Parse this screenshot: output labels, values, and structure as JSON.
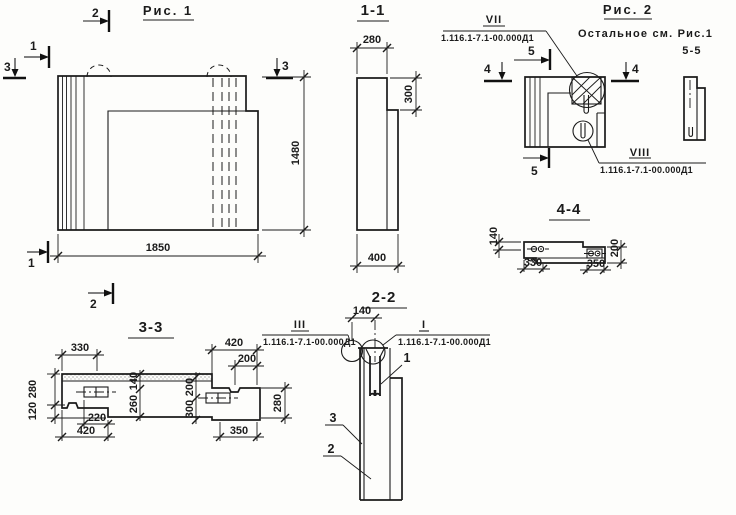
{
  "colors": {
    "ink": "#1b1b1b",
    "paper": "#fdfdfb"
  },
  "fig1": {
    "title": "Рис. 1",
    "dim_width": "1850",
    "dim_height": "1480",
    "marker_top": "2",
    "marker_upper_left": "1",
    "marker_left": "3",
    "marker_right": "3",
    "marker_bottom_left": "1",
    "marker_bottom": "2"
  },
  "sec11": {
    "title": "1-1",
    "dim_top": "280",
    "dim_step": "300",
    "dim_bottom": "400"
  },
  "fig2": {
    "title": "Рис. 2",
    "note1": "Остальное см. Рис.1",
    "note2": "5-5",
    "marker_top": "5",
    "marker_bottom": "5",
    "marker_left": "4",
    "marker_right": "4",
    "callout_vii": {
      "label": "VII",
      "doc": "1.116.1-7.1-00.000Д1"
    },
    "callout_viii": {
      "label": "VIII",
      "doc": "1.116.1-7.1-00.000Д1"
    }
  },
  "sec44": {
    "title": "4-4",
    "dim_left": "140",
    "dim_right": "200",
    "dim_330": "330",
    "dim_350": "350"
  },
  "sec33": {
    "title": "3-3",
    "dim_330": "330",
    "dim_420_top": "420",
    "dim_200_top": "200",
    "dim_280_left": "280",
    "dim_120_left": "120",
    "dim_140_mid": "140",
    "dim_260_mid": "260",
    "dim_200_mid": "200",
    "dim_300_mid": "300",
    "dim_280_right": "280",
    "dim_220": "220",
    "dim_420_bottom": "420",
    "dim_350": "350"
  },
  "sec22": {
    "title": "2-2",
    "dim_140": "140",
    "callout_iii": {
      "label": "III",
      "doc": "1.116.1-7.1-00.000Д1"
    },
    "callout_i": {
      "label": "I",
      "doc": "1.116.1-7.1-00.000Д1"
    },
    "label_1": "1",
    "label_2": "2",
    "label_3": "3"
  }
}
